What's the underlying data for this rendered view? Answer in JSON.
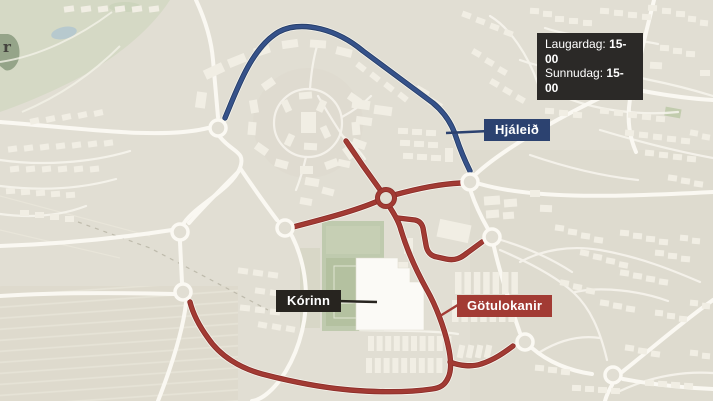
{
  "schedule": {
    "items": [
      {
        "day": "Laugardag:",
        "time": "15-00"
      },
      {
        "day": "Sunnudag:",
        "time": "15-00"
      }
    ]
  },
  "map_labels": {
    "detour": "Hjáleið",
    "venue": "Kórinn",
    "closures": "Götulokanir",
    "edge_fragment": "r"
  },
  "colors": {
    "closure_red": "#a23b34",
    "detour_blue": "#36528a",
    "dark_label_bg": "#2b2927",
    "navy_label_bg": "#2c4270",
    "red_label_bg": "#a23b34",
    "map_bg": "#e1ded3",
    "street_white": "#faf8f2",
    "park_green": "#d5d9c5",
    "pitch_green": "#b4c1a0",
    "pond_blue": "#b7c9ce"
  }
}
